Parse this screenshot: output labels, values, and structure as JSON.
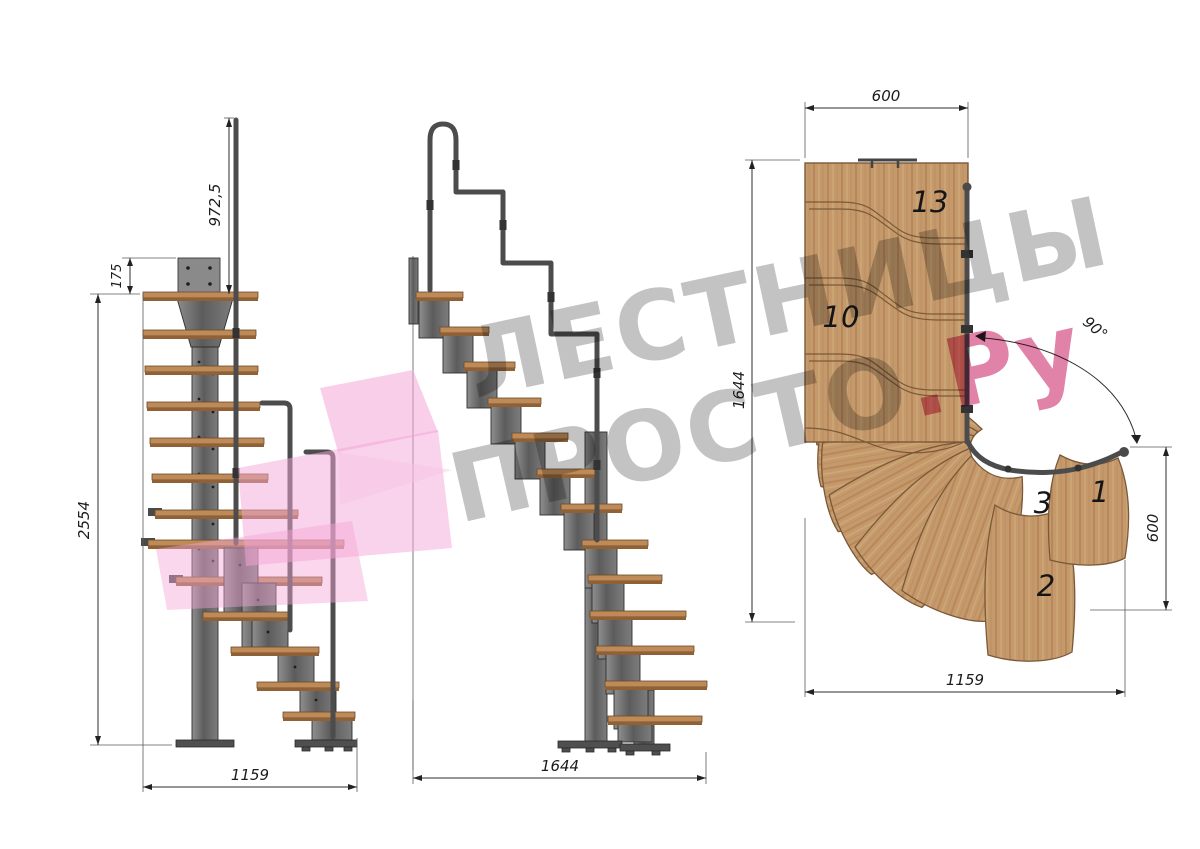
{
  "watermark": {
    "line1": "ЛЕСТНИЦЫ",
    "line2": "ПРОСТО",
    "line2_suffix": ".Ру"
  },
  "dimensions": {
    "side_view": {
      "total_height": "2554",
      "landing_offset": "175",
      "railing_height": "972,5",
      "width": "1159"
    },
    "front_view": {
      "width": "1644"
    },
    "plan_view": {
      "top_width": "600",
      "left_depth": "1644",
      "turn_angle": "90°",
      "right_depth": "600",
      "bottom_width": "1159"
    }
  },
  "plan_step_numbers": {
    "top": "13",
    "middle": "10",
    "turn_left": "3",
    "turn_right": "1",
    "turn_bottom": "2"
  },
  "colors": {
    "wood": "#c49a6c",
    "wood_edge": "#7a5838",
    "steel": "#6f6f6f",
    "dimension_line": "#2e2e2e",
    "watermark_gray": "#9a9a9a",
    "watermark_pink": "#c91d62",
    "logo_pink": "#f2a9d3"
  }
}
